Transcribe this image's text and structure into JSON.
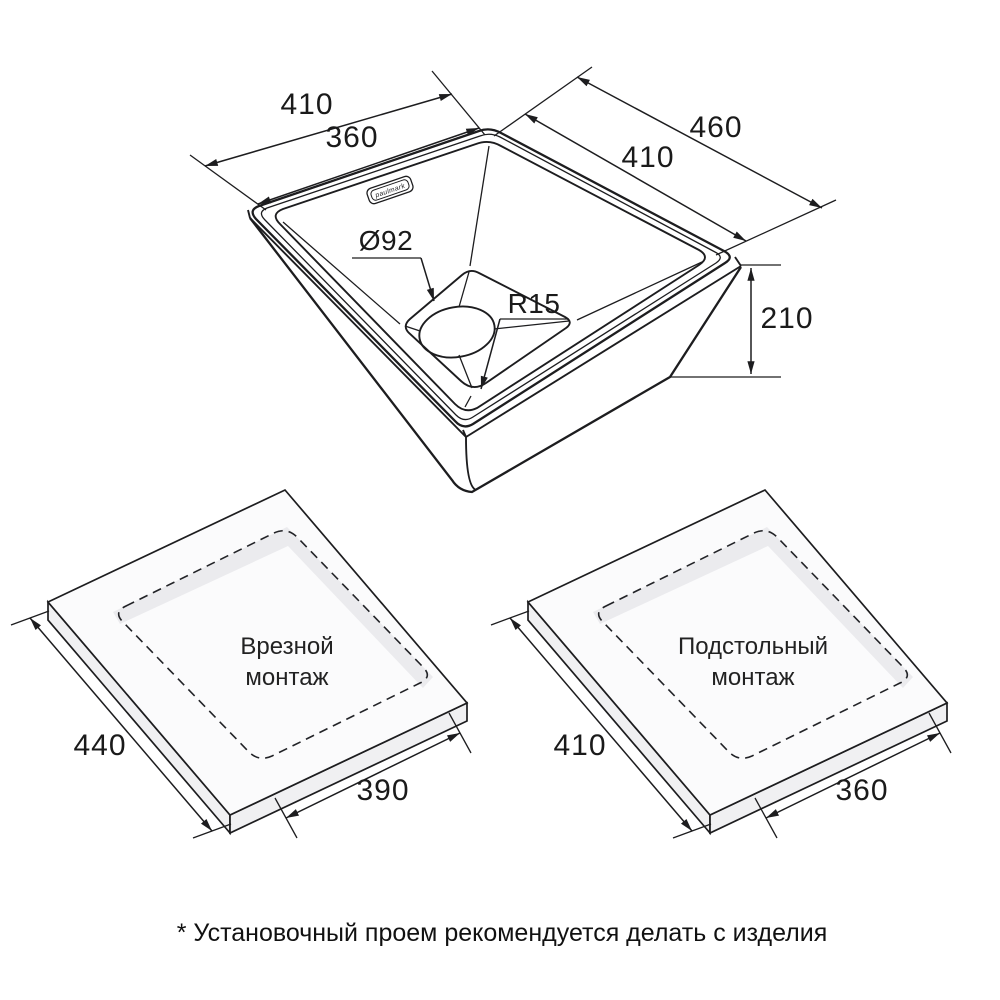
{
  "colors": {
    "line": "#1d1d1f",
    "countertop_fill": "#fbfbfc",
    "countertop_side": "#f0f0f2",
    "cut_edge_shade": "#ebebee",
    "text": "#1a1a1a"
  },
  "sink": {
    "brand_label": "paulmark",
    "dim_top_outer": "410",
    "dim_top_inner": "360",
    "dim_right_outer": "460",
    "dim_right_inner": "410",
    "dim_drain": "Ø92",
    "dim_corner_radius": "R15",
    "dim_height": "210"
  },
  "mount_inset": {
    "title_line1": "Врезной",
    "title_line2": "монтаж",
    "dim_outer": "440",
    "dim_cutout": "390"
  },
  "mount_under": {
    "title_line1": "Подстольный",
    "title_line2": "монтаж",
    "dim_outer": "410",
    "dim_cutout": "360"
  },
  "footnote": "* Установочный проем рекомендуется делать с изделия"
}
